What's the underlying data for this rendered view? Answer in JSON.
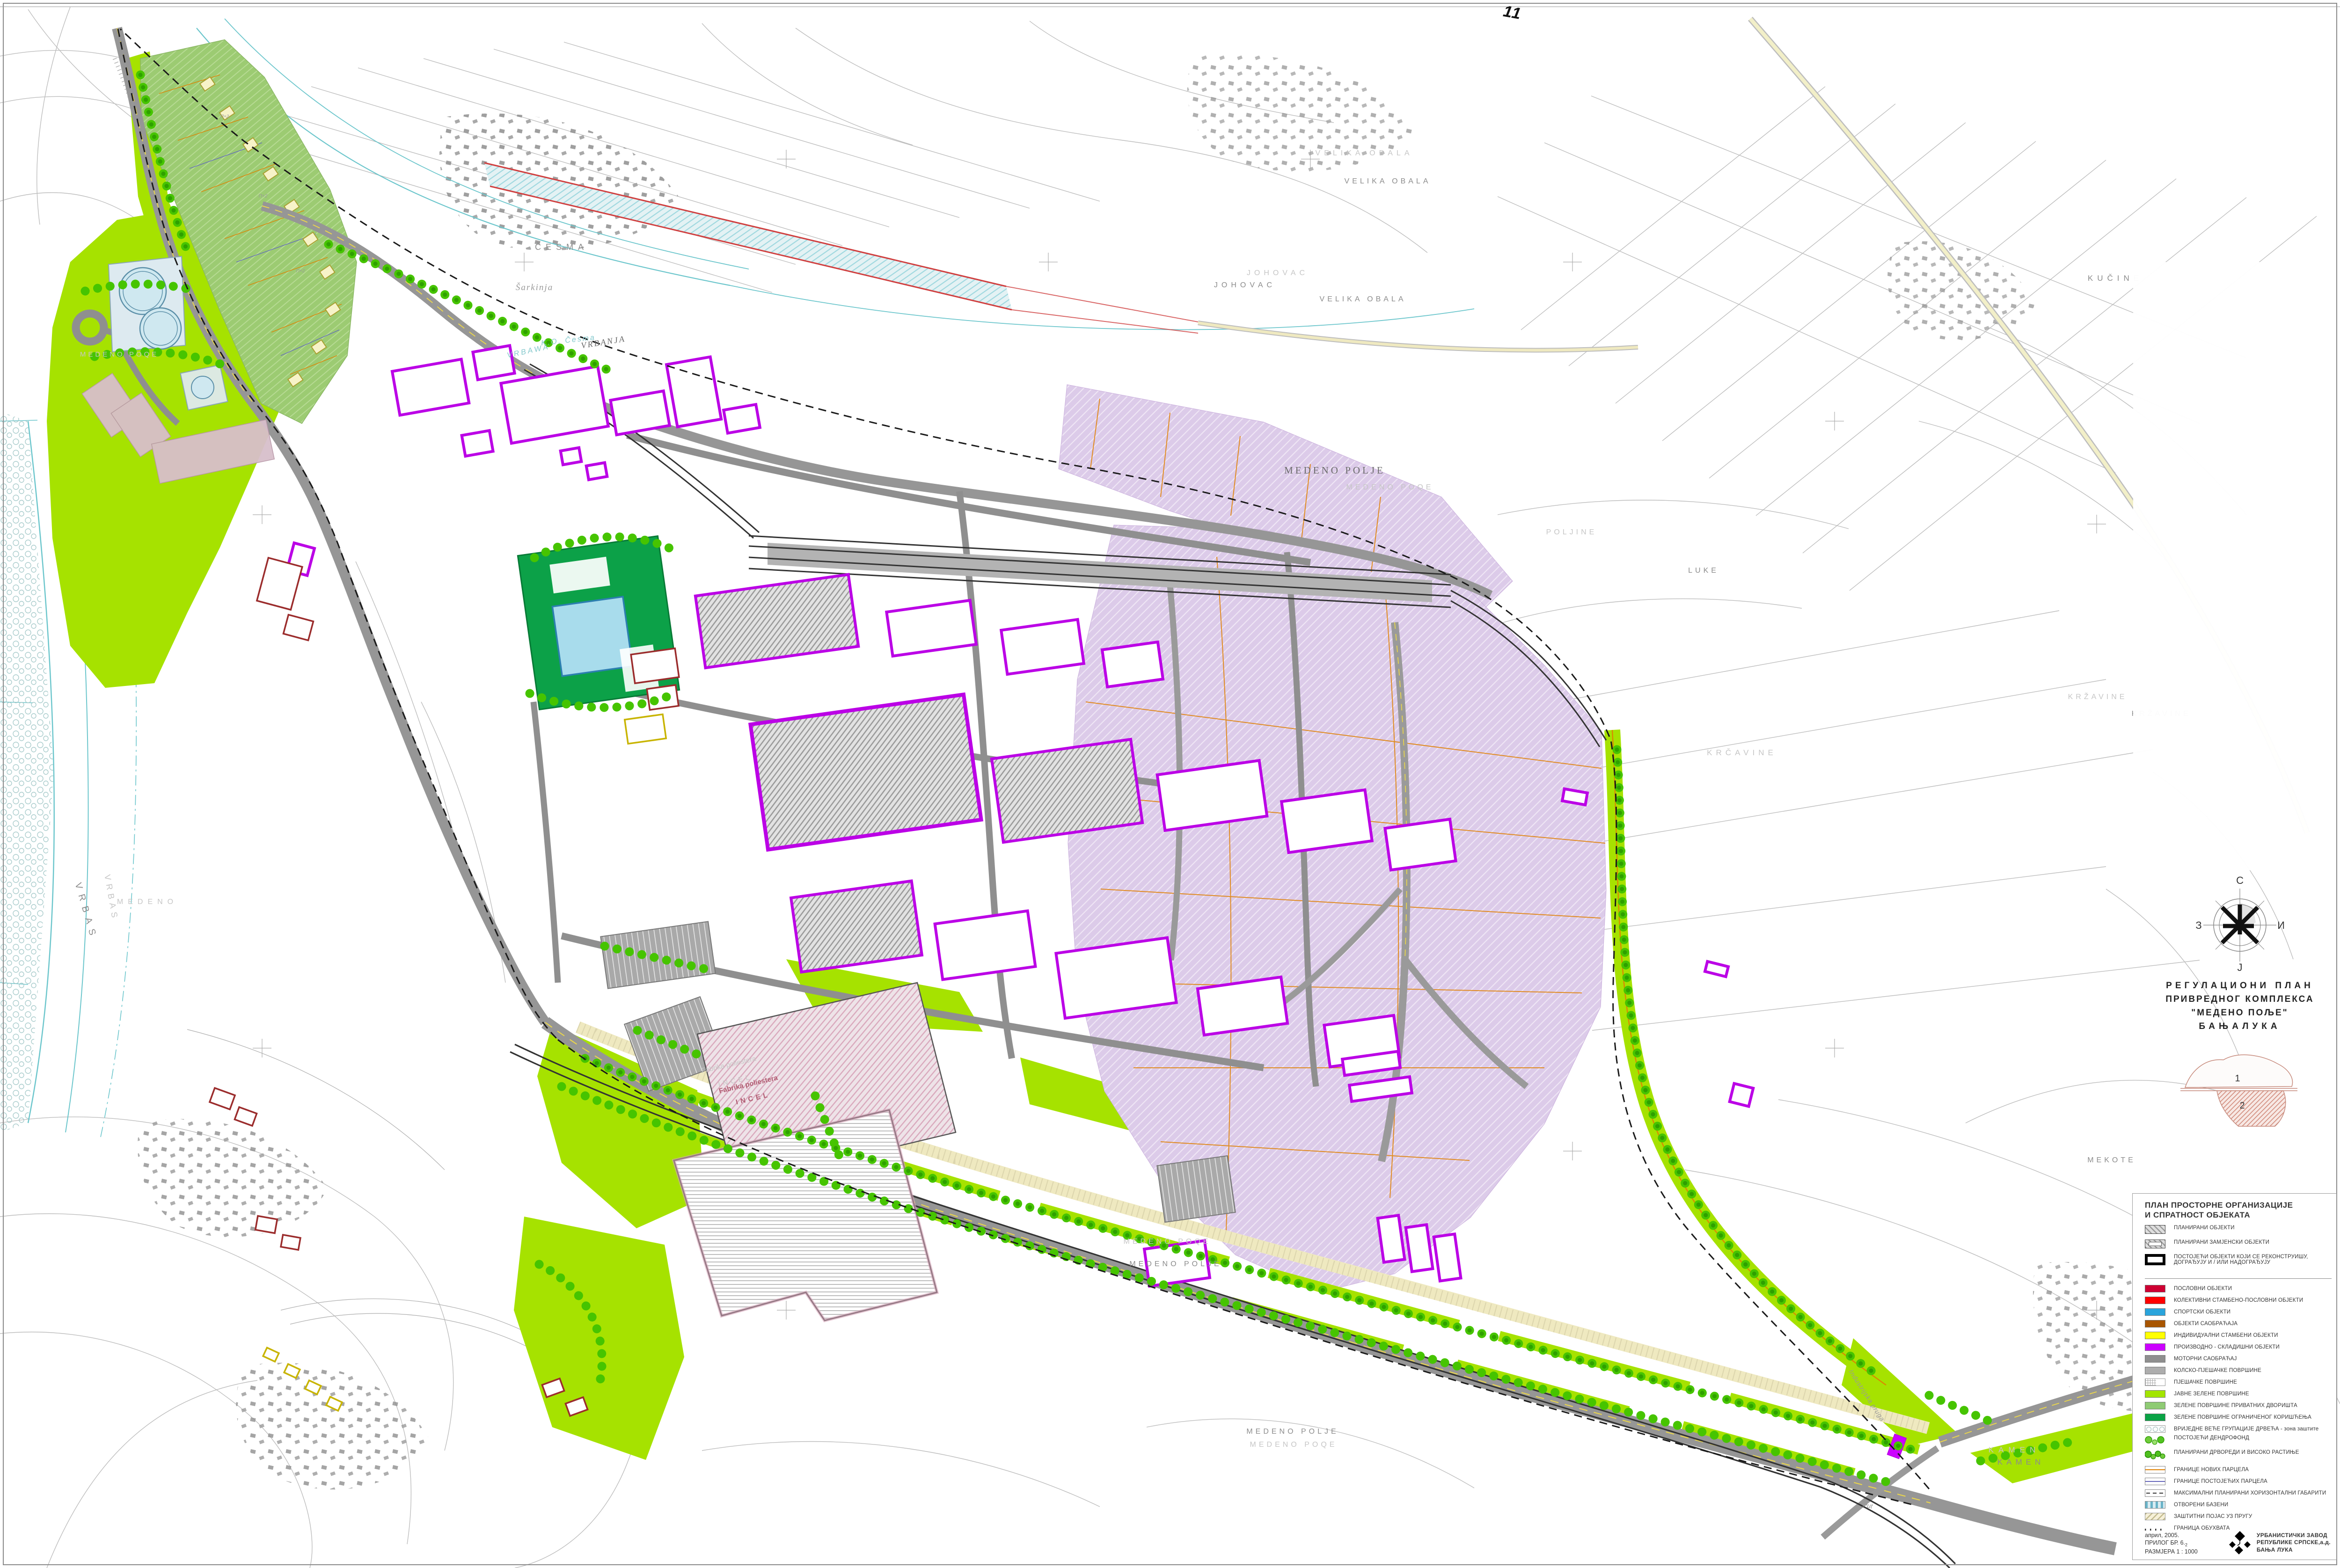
{
  "sheet": {
    "number": "11"
  },
  "compass": {
    "north": "С",
    "east": "И",
    "west": "З",
    "south": "J"
  },
  "title_block": {
    "line1": "РЕГУЛАЦИОНИ ПЛАН",
    "line2": "ПРИВРЕДНОГ КОМПЛЕКСА",
    "line3": "\"МЕДЕНО ПОЉЕ\"",
    "line4": "БАЊАЛУКА"
  },
  "key_map": {
    "sheet1": "1",
    "sheet2": "2"
  },
  "legend": {
    "heading_line1": "ПЛАН ПРОСТОРНЕ ОРГАНИЗАЦИЈЕ",
    "heading_line2": "И СПРАТНОСТ ОБЈЕКАТА",
    "items": [
      {
        "label": "ПЛАНИРАНИ  ОБЈЕКТИ",
        "swatch": "hatch-gray"
      },
      {
        "label": "ПЛАНИРАНИ ЗАМЈЕНСКИ ОБЈЕКТИ",
        "swatch": "hatch-gray-inner"
      },
      {
        "label": "ПОСТОЈЕЋИ ОБЈЕКТИ КОЈИ СЕ РЕКОНСТРУИШУ, ДОГРАЂУЈУ И / ИЛИ  НАДОГРАЂУЈУ",
        "swatch": "black-frame"
      },
      {
        "label": "ПОСЛОВНИ ОБЈЕКТИ",
        "color": "#CE0033"
      },
      {
        "label": "КОЛЕКТИВНИ СТАМБЕНО-ПОСЛОВНИ ОБЈЕКТИ",
        "color": "#FF0000"
      },
      {
        "label": "СПОРТСКИ ОБЈЕКТИ",
        "color": "#29A4DC"
      },
      {
        "label": "ОБЈЕКТИ САОБРАЋАЈА",
        "color": "#A85500"
      },
      {
        "label": "ИНДИВИДУАЛНИ СТАМБЕНИ ОБЈЕКТИ",
        "color": "#FFFF00"
      },
      {
        "label": "ПРОИЗВОДНО - СКЛАДИШНИ ОБЈЕКТИ",
        "color": "#CC00FF"
      },
      {
        "label": "МОТОРНИ САОБРАЋАЈ",
        "color": "#8F8F8F"
      },
      {
        "label": "КОЛСКО-ПЈЕШАЧКЕ ПОВРШИНЕ",
        "color": "#ADADAD"
      },
      {
        "label": "ПЈЕШАЧКЕ ПОВРШИНЕ",
        "swatch": "grid"
      },
      {
        "label": "ЈАВНЕ ЗЕЛЕНЕ ПОВРШИНЕ",
        "color": "#A3E500"
      },
      {
        "label": "ЗЕЛЕНЕ ПОВРШИНЕ ПРИВАТНИХ ДВОРИШТА",
        "color": "#8FCB74"
      },
      {
        "label": "ЗЕЛЕНЕ ПОВРШИНЕ ОГРАНИЧЕНОГ КОРИШЋЕЊА",
        "color": "#0AA345"
      },
      {
        "label": "ВРИЈЕДНЕ ВЕЋЕ ГРУПАЦИЈЕ ДРВЕЋА - зона заштите",
        "swatch": "circles"
      },
      {
        "label": "ПОСТОЈЕЋИ ДЕНДРОФОНД",
        "swatch": "trees-existing"
      },
      {
        "label": "ПЛАНИРАНИ ДРВОРЕДИ И ВИСОКО РАСТИЊЕ",
        "swatch": "trees-planned"
      },
      {
        "label": "ГРАНИЦЕ НОВИХ ПАРЦЕЛА",
        "swatch": "line-orange"
      },
      {
        "label": "ГРАНИЦЕ ПОСТОЈЕЋИХ ПАРЦЕЛА",
        "swatch": "line-blue"
      },
      {
        "label": "МАКСИМАЛНИ ПЛАНИРАНИ ХОРИЗОНТАЛНИ ГАБАРИТИ",
        "swatch": "dashed"
      },
      {
        "label": "ОТВОРЕНИ БАЗЕНИ",
        "swatch": "pool"
      },
      {
        "label": "ЗАШТИТНИ ПОЈАС УЗ ПРУГУ",
        "swatch": "rail-band"
      },
      {
        "label": "ГРАНИЦА ОБУХВАТА",
        "swatch": "dots"
      }
    ]
  },
  "footer": {
    "date": "април, 2005.",
    "attachment": "ПРИЛОГ БР. 6.",
    "attachment_sub": "2",
    "scale": "РАЗМЈЕРА  1 : 1000"
  },
  "publisher": {
    "line1": "УРБАНИСТИЧКИ  ЗАВОД",
    "line2": "РЕПУБЛИКЕ СРПСКЕ,а.д.",
    "line3": "БАЊА ЛУКА"
  },
  "map": {
    "labels": [
      {
        "text": "VRBAS"
      },
      {
        "text": "VRBAS"
      },
      {
        "text": "MEDENO"
      },
      {
        "text": "ČESMA"
      },
      {
        "text": "Šarkinja"
      },
      {
        "text": "K.O. Česma"
      },
      {
        "text": "VRBANJA"
      },
      {
        "text": "VRBAWA"
      },
      {
        "text": "JOHOVAC"
      },
      {
        "text": "JOHOVAC"
      },
      {
        "text": "VELIKA OBALA"
      },
      {
        "text": "VELIKA OBALA"
      },
      {
        "text": "VELIKA OBALA"
      },
      {
        "text": "MEDENO POLJE"
      },
      {
        "text": "MEDENO POQE"
      },
      {
        "text": "MEDENO POQE"
      },
      {
        "text": "MEDENO POLJE"
      },
      {
        "text": "MEDENO POLJE"
      },
      {
        "text": "MEDENO POQE"
      },
      {
        "text": "KRČAVINE"
      },
      {
        "text": "KRŽAVINE"
      },
      {
        "text": "KRŽAVINE"
      },
      {
        "text": "POLJINE"
      },
      {
        "text": "LUKE"
      },
      {
        "text": "MEKOTE"
      },
      {
        "text": "KAMEN"
      },
      {
        "text": "KAMEN"
      },
      {
        "text": "Industrijska pruga"
      },
      {
        "text": "Put"
      },
      {
        "text": "Fabrika poliestera"
      },
      {
        "text": "INCEL"
      },
      {
        "text": "Fabrika poliestera"
      },
      {
        "text": "INCEL"
      },
      {
        "text": "П+2"
      },
      {
        "text": "П+2"
      },
      {
        "text": "П+2"
      },
      {
        "text": "MEDENO POQE"
      },
      {
        "text": "KUČINE"
      }
    ]
  },
  "colors": {
    "green-public": "#A6E200",
    "green-private": "#9CCB72",
    "green-restricted": "#0CA148",
    "lavender": "#DCCBE9",
    "purple": "#BB00E6",
    "industry-purple": "#CC00FF",
    "road": "#969696",
    "rail": "#333333",
    "water": "#6CC6CC",
    "parcel-orange": "#E08000",
    "parcel-blue": "#6666BB",
    "existing-red": "#9B2C2C",
    "tree": "#3DBE00",
    "tree-dark": "#2FA000",
    "pale-band": "#EFE9C0",
    "boundary": "#1A1A1A"
  }
}
